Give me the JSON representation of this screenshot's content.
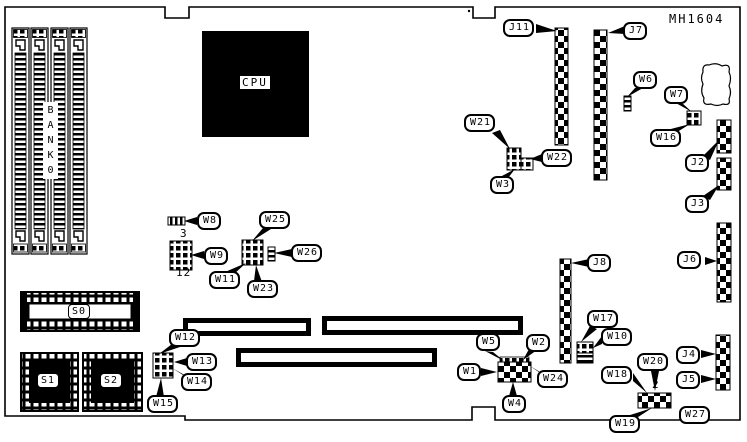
{
  "part_number": "MH1604",
  "labels": {
    "cpu": "CPU",
    "bank0": "B\nA\nN\nK\n0",
    "s0": "S0",
    "s1": "S1",
    "s2": "S2",
    "j2": "J2",
    "j3": "J3",
    "j4": "J4",
    "j5": "J5",
    "j6": "J6",
    "j7": "J7",
    "j8": "J8",
    "j11": "J11",
    "w1": "W1",
    "w2": "W2",
    "w3": "W3",
    "w4": "W4",
    "w5": "W5",
    "w6": "W6",
    "w7": "W7",
    "w8": "W8",
    "w9": "W9",
    "w10": "W10",
    "w11": "W11",
    "w12": "W12",
    "w13": "W13",
    "w14": "W14",
    "w15": "W15",
    "w16": "W16",
    "w17": "W17",
    "w18": "W18",
    "w19": "W19",
    "w20": "W20",
    "w21": "W21",
    "w22": "W22",
    "w23": "W23",
    "w24": "W24",
    "w25": "W25",
    "w26": "W26",
    "w27": "W27"
  },
  "pin_counts": {
    "w8_pins": "3",
    "w9_pins": "12",
    "w20_pins": "2"
  },
  "colors": {
    "line": "#000000",
    "background": "#ffffff"
  }
}
